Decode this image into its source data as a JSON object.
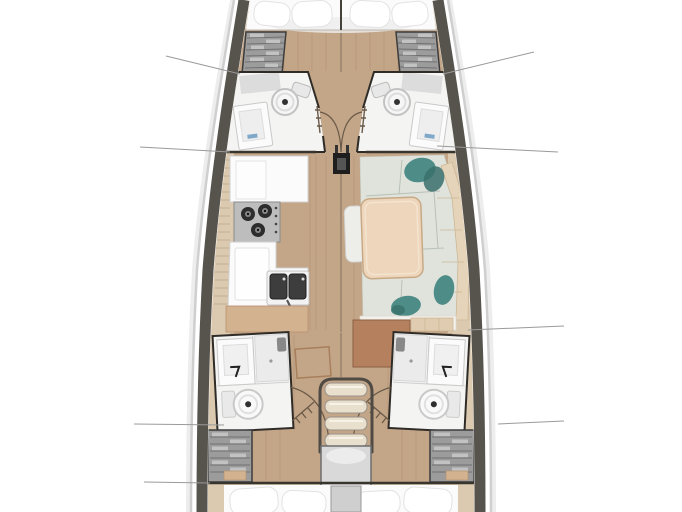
{
  "figure": {
    "type": "yacht-interior-floor-plan",
    "label": "Top-down sailboat interior layout plan"
  },
  "colors": {
    "background": "#ffffff",
    "hull_band": "#57534d",
    "hull_rim": "#cfcfcf",
    "hull_shadow": "#ededed",
    "deck": "#dccab0",
    "deck_line": "#c5ae8f",
    "wood": "#c3a587",
    "wood_line": "#aa8c6e",
    "room_white": "#f4f4f3",
    "wall": "#2f2c28",
    "fixture_white": "#fbfbfb",
    "fixture_edge": "#c9c9c9",
    "locker": "#9c9c9c",
    "locker_slat": "#6f6f6f",
    "locker_light": "#c7c7c7",
    "stove": "#bdbdbd",
    "burner": "#2d2d2d",
    "basin": "#3d3d3d",
    "salon_cushion": "#dfe3dc",
    "cushion_seam": "#b9c0b6",
    "teal": "#4e8c87",
    "teal_dark": "#39706c",
    "table": "#eed6bc",
    "table_edge": "#c8a985",
    "brown_box": "#b5805e",
    "bed": "#fbfbfb",
    "bed_shadow": "#e6e6e6",
    "step": "#e9dfcd",
    "step_edge": "#98938b",
    "platform": "#d9d9d9",
    "door_line": "#6a5a49",
    "leader_line": "#9a9a9a",
    "mast": "#1e1e1e",
    "soap_blue": "#7fa8c9",
    "drawer_tan": "#d3b28f"
  }
}
